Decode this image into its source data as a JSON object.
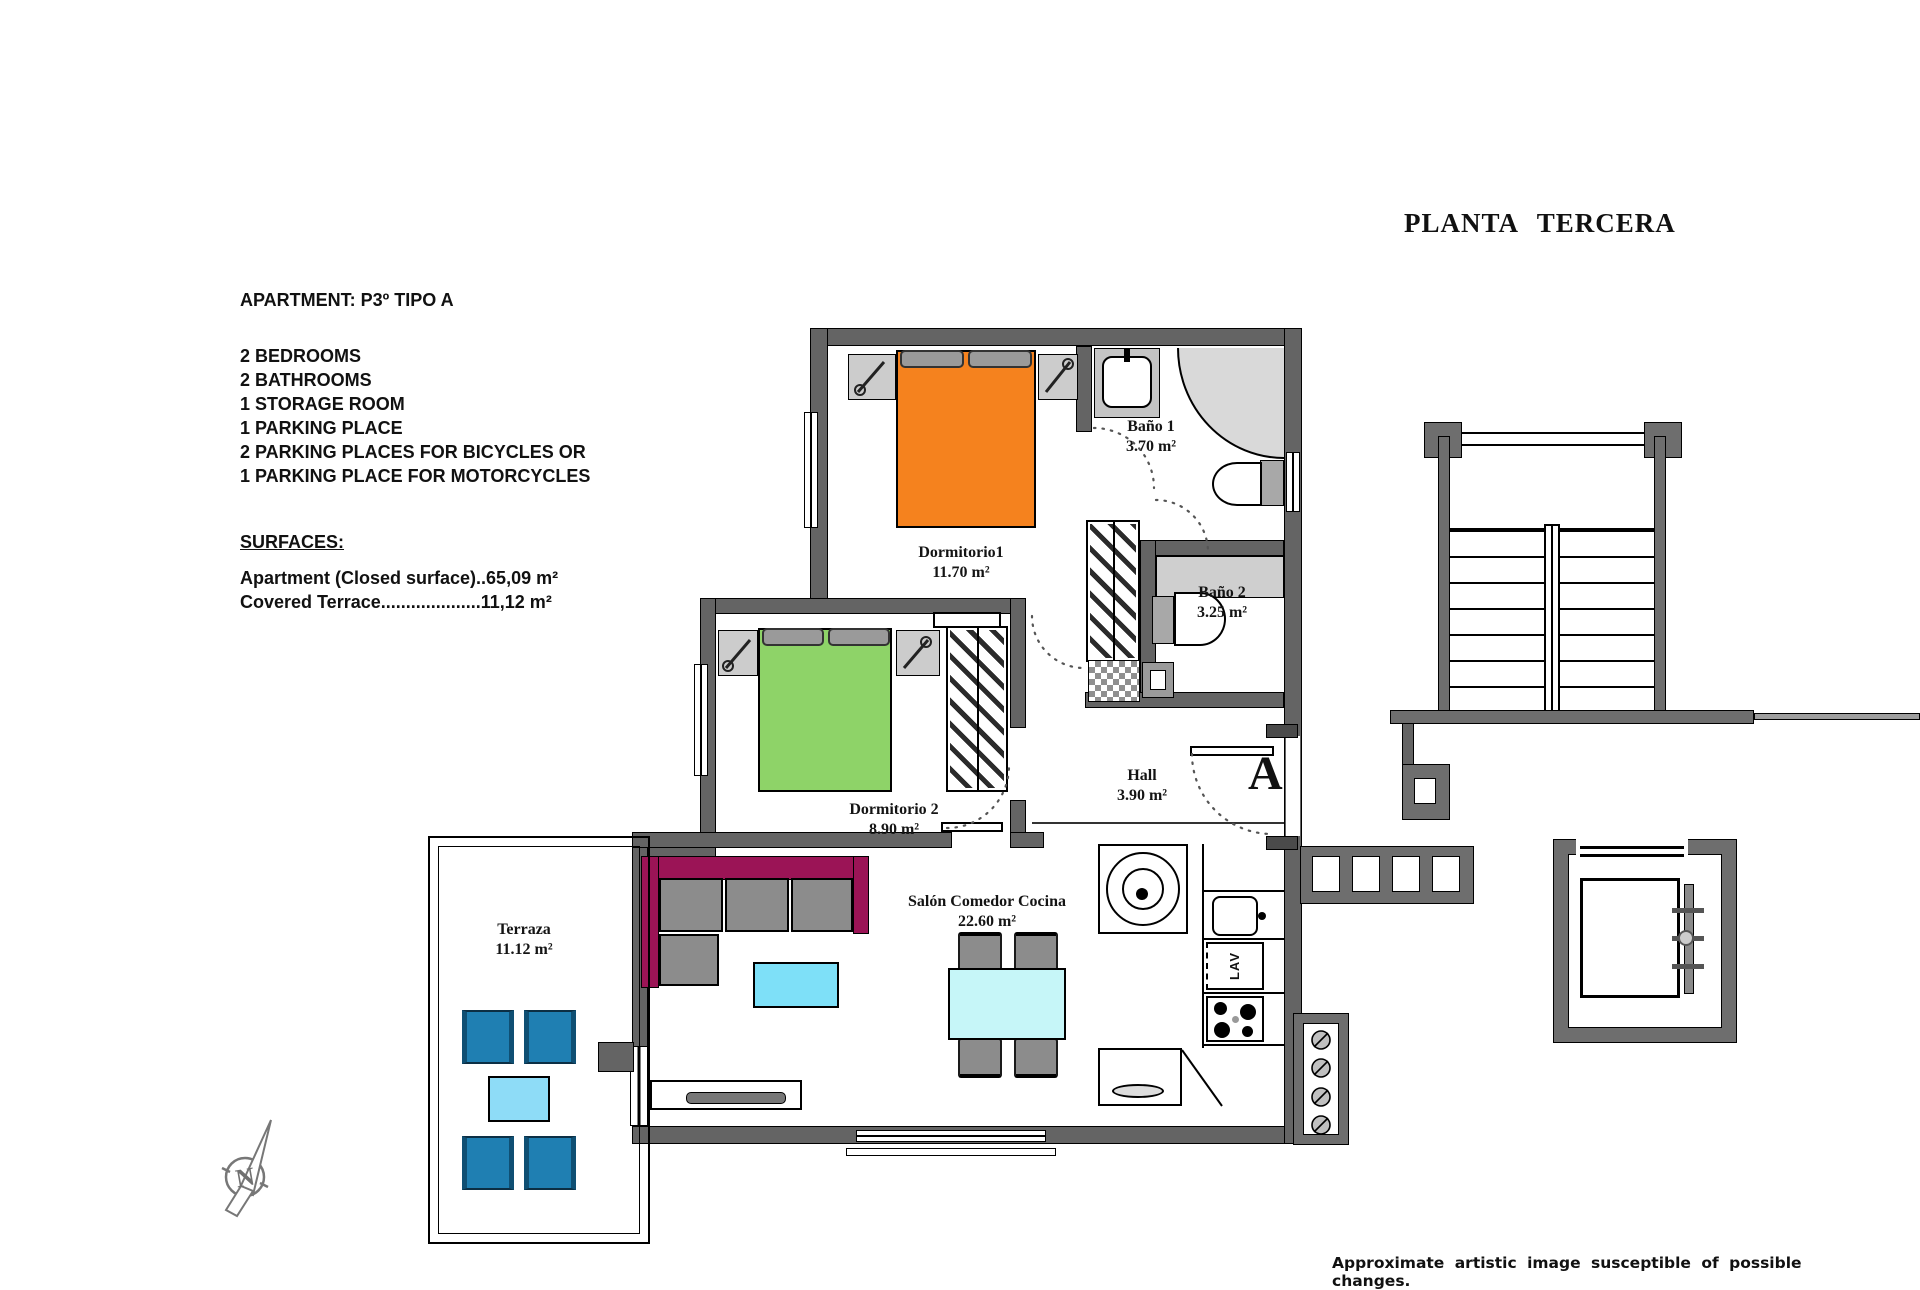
{
  "title": "PLANTA TERCERA",
  "info": {
    "heading": "APARTMENT: P3º TIPO A",
    "features": [
      "2 BEDROOMS",
      "2 BATHROOMS",
      "1 STORAGE ROOM",
      "1 PARKING PLACE",
      "2 PARKING PLACES FOR BICYCLES OR",
      "1 PARKING PLACE FOR MOTORCYCLES"
    ],
    "surfaces_heading": "SURFACES:",
    "surfaces": [
      "Apartment (Closed surface)..65,09 m²",
      "Covered Terrace....................11,12 m²"
    ]
  },
  "rooms": {
    "dormitorio1": {
      "name": "Dormitorio1",
      "area": "11.70 m²"
    },
    "bano1": {
      "name": "Baño 1",
      "area": "3.70 m²"
    },
    "bano2": {
      "name": "Baño 2",
      "area": "3.25 m²"
    },
    "dormitorio2": {
      "name": "Dormitorio 2",
      "area": "8.90 m²"
    },
    "hall": {
      "name": "Hall",
      "area": "3.90 m²"
    },
    "salon": {
      "name": "Salón Comedor Cocina",
      "area": "22.60 m²"
    },
    "terraza": {
      "name": "Terraza",
      "area": "11.12 m²"
    }
  },
  "plan": {
    "apartment_letter": "A",
    "dishwasher_label": "LAV",
    "compass_letter": "N"
  },
  "disclaimer": "Approximate artistic image susceptible of possible changes.",
  "colors": {
    "wall": "#646464",
    "bed1": "#f5821e",
    "bed2": "#8ed368",
    "sofa": "#9b1456",
    "cushion": "#8c8c8c",
    "coffee_table": "#7ee0f8",
    "dining_table": "#c6f6f8",
    "terrace_chair": "#1f7fb2",
    "terrace_table": "#8edcf7"
  }
}
